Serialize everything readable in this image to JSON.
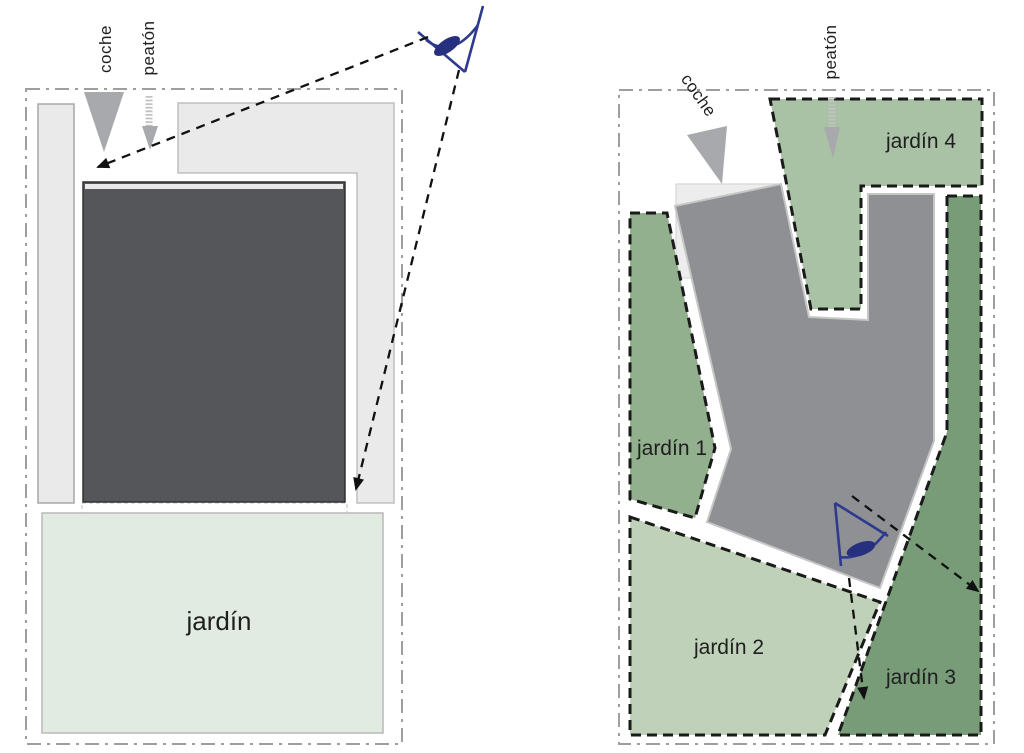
{
  "left_panel": {
    "labels": {
      "car": "coche",
      "pedestrian": "peatón",
      "garden": "jardín"
    }
  },
  "right_panel": {
    "labels": {
      "car": "coche",
      "pedestrian": "peatón",
      "garden1": "jardín 1",
      "garden2": "jardín 2",
      "garden3": "jardín 3",
      "garden4": "jardín 4"
    }
  },
  "colors": {
    "site_border": "#9e9e9e",
    "pavement": "#eaeaea",
    "pavement_edge": "#b4b4b4",
    "building_left": "#54565a",
    "building_right": "#8e9093",
    "building_edge_light": "#d9d9d9",
    "garden_left": "#e1ebe1",
    "garden1": "#92af8e",
    "garden2": "#bfd1b8",
    "garden3": "#789c78",
    "gar4_": "#a9c2a5",
    "garden4": "#a9c2a5",
    "access_gray": "#a7a9ac",
    "ladder_gray": "#c2c2c2",
    "dashed_black": "#1a1a1a",
    "eye_blue": "#2d3a8d",
    "ghost_line": "#cccccc"
  }
}
